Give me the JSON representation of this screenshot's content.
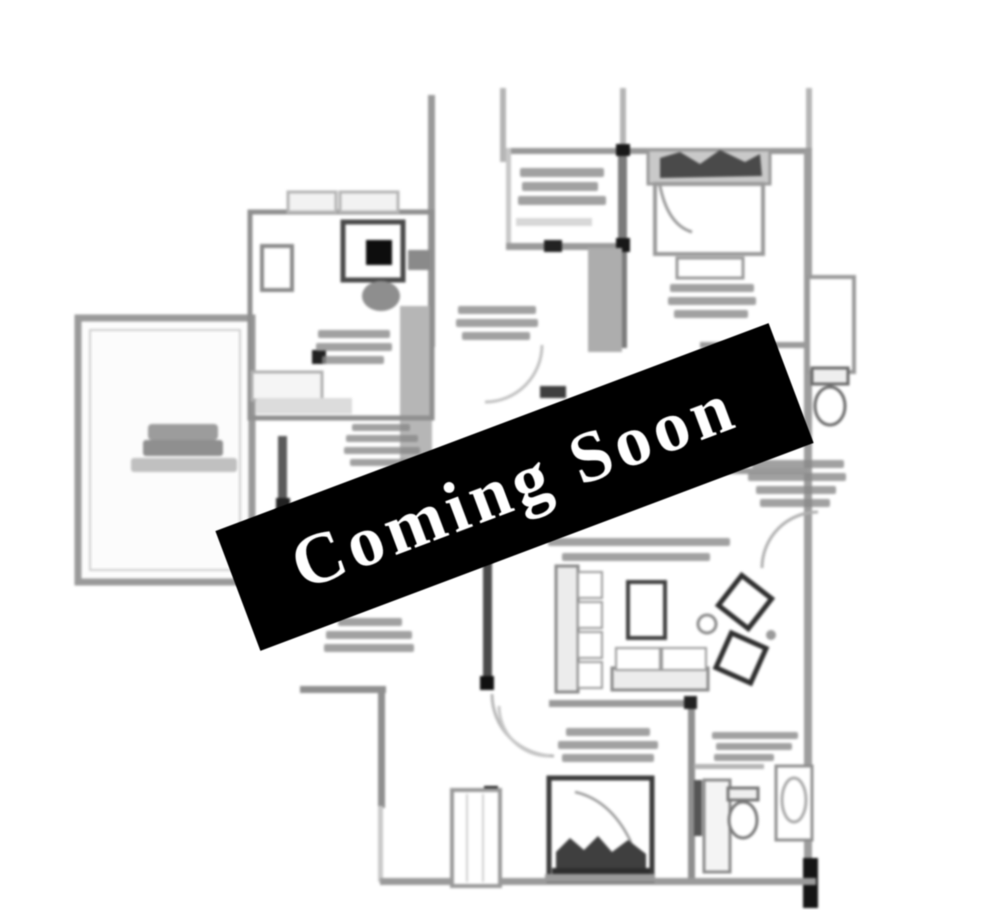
{
  "banner": {
    "label": "Coming Soon",
    "background_color": "#000000",
    "text_color": "#ffffff",
    "rotation_deg": -20.6
  },
  "plan": {
    "background_color": "#ffffff",
    "wall_color": "#8f8f8f",
    "dark_ink_color": "#2e2e2e",
    "label_smudge_color": "#8a8a8a"
  }
}
